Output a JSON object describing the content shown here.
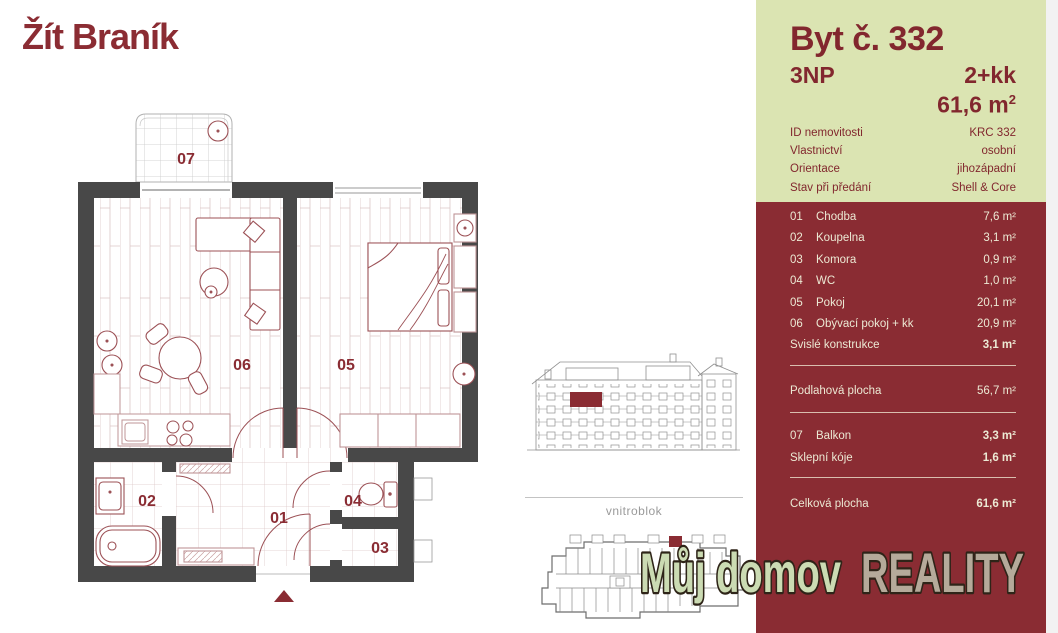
{
  "logo": {
    "text": "Žít Braník"
  },
  "panel": {
    "title": "Byt č. 332",
    "floor": "3NP",
    "layout": "2+kk",
    "area_value": "61,6 m",
    "area_sup": "2",
    "details": [
      {
        "label": "ID nemovitosti",
        "value": "KRC 332"
      },
      {
        "label": "Vlastnictví",
        "value": "osobní"
      },
      {
        "label": "Orientace",
        "value": "jihozápadní"
      },
      {
        "label": "Stav při předání",
        "value": "Shell & Core"
      }
    ],
    "rooms": [
      {
        "num": "01",
        "name": "Chodba",
        "area": "7,6 m²"
      },
      {
        "num": "02",
        "name": "Koupelna",
        "area": "3,1 m²"
      },
      {
        "num": "03",
        "name": "Komora",
        "area": "0,9 m²"
      },
      {
        "num": "04",
        "name": "WC",
        "area": "1,0 m²"
      },
      {
        "num": "05",
        "name": "Pokoj",
        "area": "20,1 m²"
      },
      {
        "num": "06",
        "name": "Obývací pokoj + kk",
        "area": "20,9 m²"
      }
    ],
    "construction": {
      "label": "Svislé konstrukce",
      "area": "3,1 m²"
    },
    "floor_area": {
      "label": "Podlahová plocha",
      "area": "56,7 m²"
    },
    "balcony": {
      "num": "07",
      "name": "Balkon",
      "area": "3,3 m²"
    },
    "cellar": {
      "name": "Sklepní kóje",
      "area": "1,6 m²"
    },
    "total": {
      "label": "Celková plocha",
      "area": "61,6 m²"
    }
  },
  "plan": {
    "labels": {
      "r01": "01",
      "r02": "02",
      "r03": "03",
      "r04": "04",
      "r05": "05",
      "r06": "06",
      "r07": "07"
    }
  },
  "site": {
    "caption": "vnitroblok"
  },
  "watermark": {
    "part1": "Můj domov",
    "part2": "REALITY"
  },
  "colors": {
    "maroon": "#8a2c33",
    "panel_green": "#dbe4b2",
    "panel_text": "#ece9d4",
    "wall_gray": "#484848",
    "furniture": "#9c5156",
    "lineart": "#909090",
    "watermark_green": "#cbdbb3",
    "watermark_tan": "#b5aa9a"
  }
}
